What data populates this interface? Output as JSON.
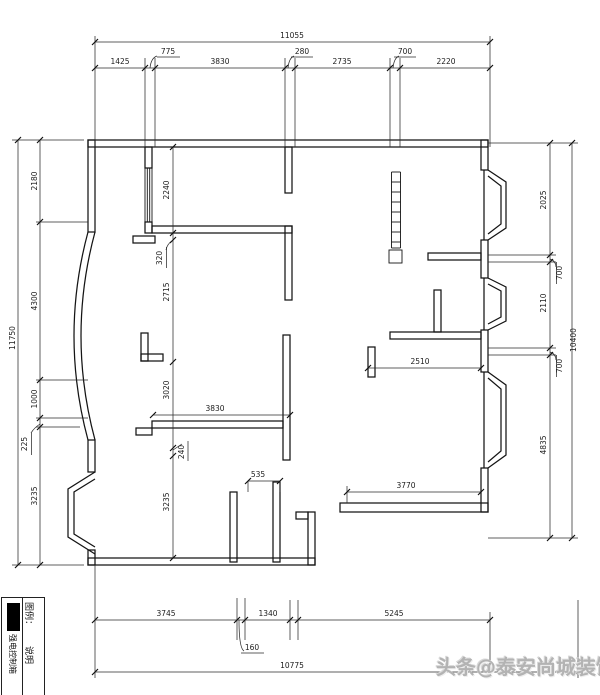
{
  "dimensions": {
    "top": {
      "total": "11055",
      "d1": "1425",
      "d2": "775",
      "d3": "3830",
      "d4": "280",
      "d5": "2735",
      "d6": "700",
      "d7": "2220"
    },
    "left": {
      "total": "11750",
      "d1": "2180",
      "d2": "4300",
      "d3": "1000",
      "d4": "225",
      "d5": "3235"
    },
    "right": {
      "total": "10400",
      "d1": "2025",
      "d2": "700",
      "d3": "2110",
      "d4": "700",
      "d5": "4835"
    },
    "bottom": {
      "total": "10775",
      "d1": "3745",
      "d2": "160",
      "d3": "1340",
      "d4": "5245"
    },
    "interior": {
      "v1": "2240",
      "v2": "320",
      "v3": "2715",
      "v4": "3020",
      "v5": "240",
      "v6": "3235",
      "h1": "3830",
      "h2": "2510",
      "h3": "3770",
      "h4": "535"
    }
  },
  "legend": {
    "header": "图例：",
    "desc_header": "说明",
    "item_desc": "强电控制箱",
    "symbol": "filled-black-rectangle"
  },
  "watermark": {
    "text": "头条@泰安尚城装饰"
  }
}
